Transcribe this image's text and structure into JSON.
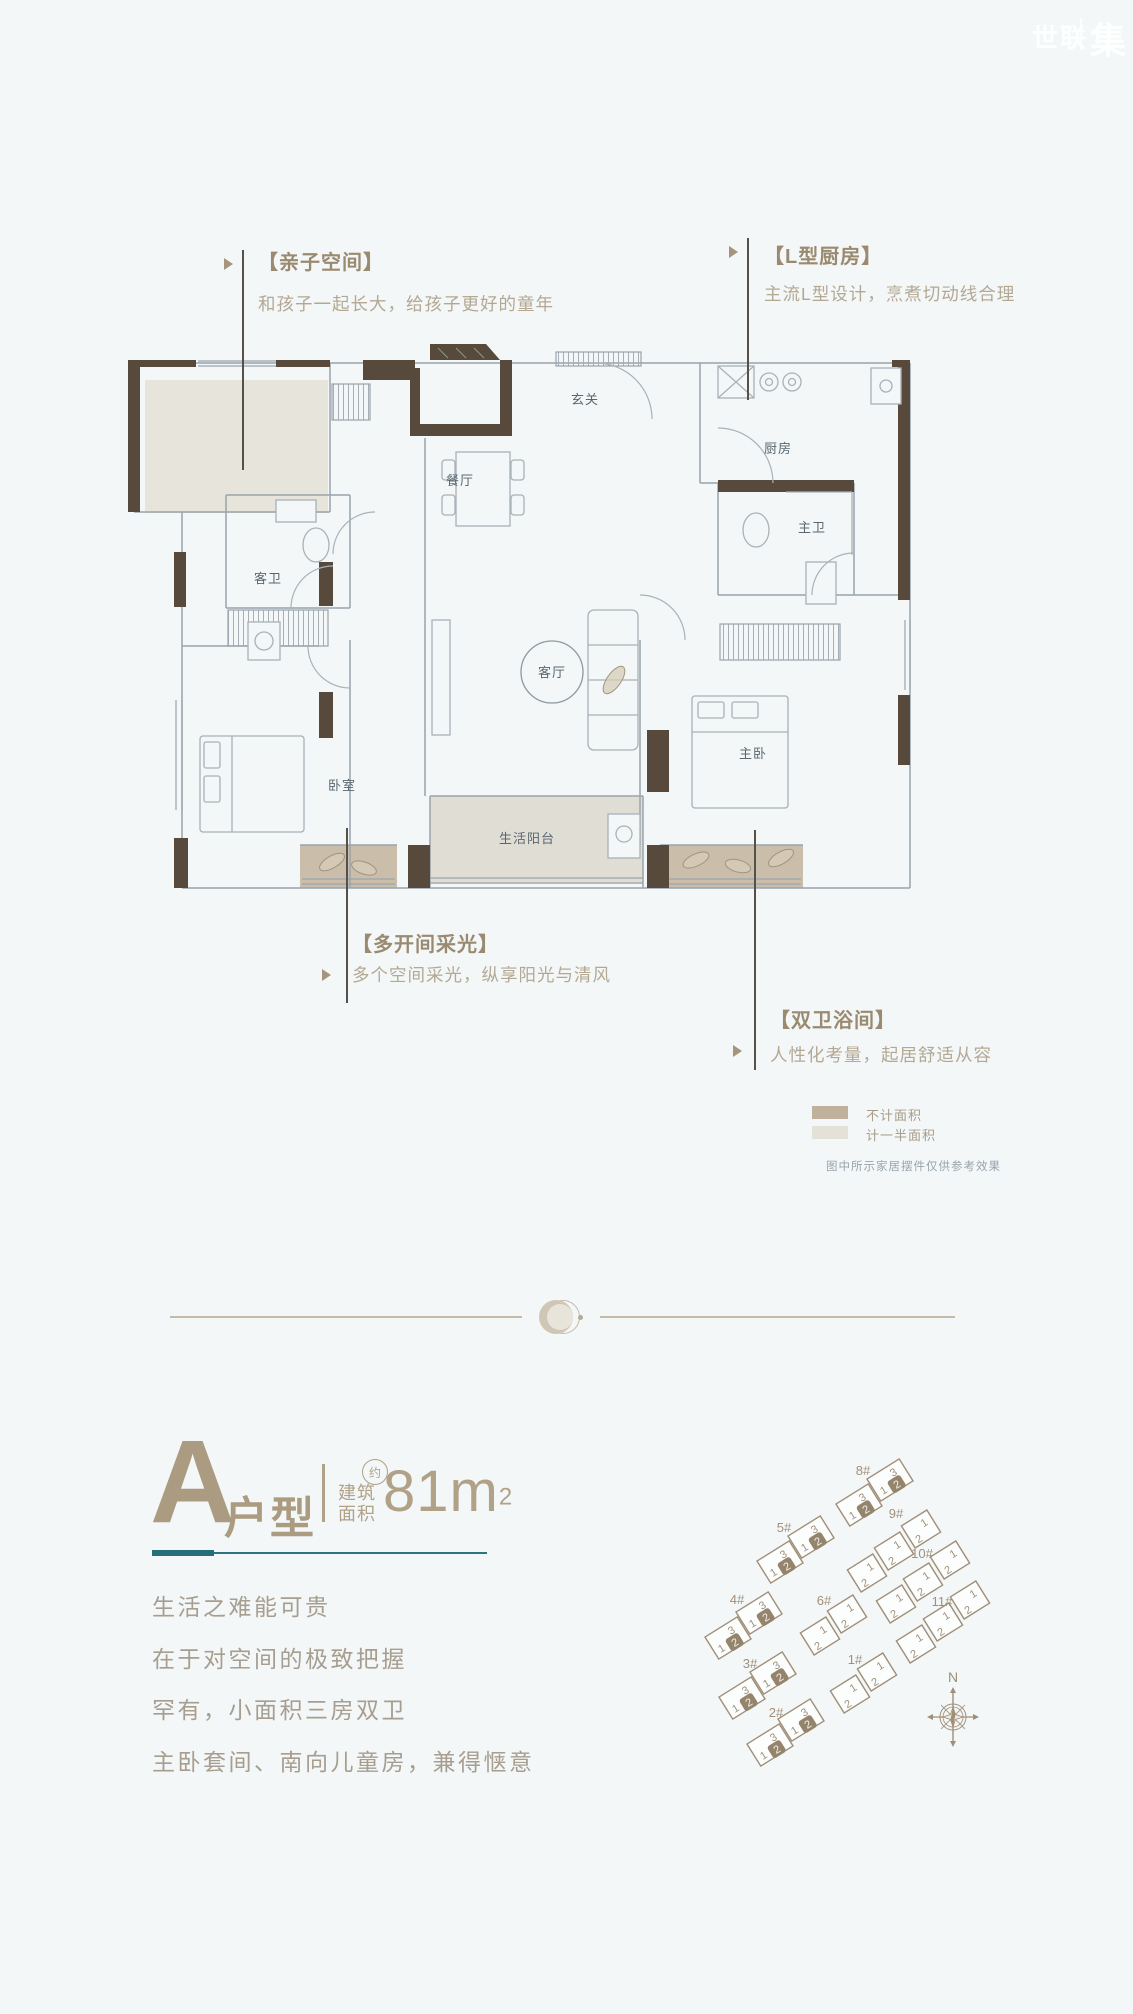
{
  "watermark": {
    "brand_left": "世联",
    "brand_right": "集"
  },
  "callouts": {
    "parent_child": {
      "title": "【亲子空间】",
      "desc": "和孩子一起长大，给孩子更好的童年"
    },
    "l_kitchen": {
      "title": "【L型厨房】",
      "desc": "主流L型设计，烹煮切动线合理"
    },
    "multi_light": {
      "title": "【多开间采光】",
      "desc": "多个空间采光，纵享阳光与清风"
    },
    "double_bath": {
      "title": "【双卫浴间】",
      "desc": "人性化考量，起居舒适从容"
    }
  },
  "floorplan": {
    "rooms": {
      "entry": "玄关",
      "dining": "餐厅",
      "kitchen": "厨房",
      "guest_bath": "客卫",
      "master_bath": "主卫",
      "living": "客厅",
      "master_bed": "主卧",
      "bedroom": "卧室",
      "balcony": "生活阳台"
    }
  },
  "legend": {
    "items": [
      {
        "label": "不计面积",
        "color": "#bfb19c"
      },
      {
        "label": "计一半面积",
        "color": "#e4e1d9"
      }
    ],
    "note": "图中所示家居摆件仅供参考效果"
  },
  "unit_info": {
    "letter": "A",
    "suffix": "户型",
    "area_prefix_line1": "建筑",
    "area_prefix_line2": "面积",
    "approx": "约",
    "area_number": "81",
    "area_unit": "m",
    "area_exponent": "2"
  },
  "slogans": [
    "生活之难能可贵",
    "在于对空间的极致把握",
    "罕有，小面积三房双卫",
    "主卧套间、南向儿童房，兼得惬意"
  ],
  "siteplan": {
    "compass_label": "N",
    "step_units": {
      "a": "1",
      "b": "3",
      "hl": "2"
    },
    "row_units": {
      "a": "1",
      "b": "2"
    },
    "buildings": [
      {
        "label": "1#",
        "type": "row",
        "blocks": 2,
        "x": 150,
        "y": 254,
        "lx": 155,
        "ly": 224
      },
      {
        "label": "2#",
        "type": "step",
        "blocks": 2,
        "x": 70,
        "y": 305,
        "lx": 76,
        "ly": 277
      },
      {
        "label": "3#",
        "type": "step",
        "blocks": 2,
        "x": 42,
        "y": 258,
        "lx": 50,
        "ly": 228
      },
      {
        "label": "4#",
        "type": "step",
        "blocks": 2,
        "x": 28,
        "y": 198,
        "lx": 37,
        "ly": 164
      },
      {
        "label": "5#",
        "type": "step",
        "blocks": 2,
        "x": 80,
        "y": 122,
        "lx": 84,
        "ly": 92
      },
      {
        "label": "6#",
        "type": "row",
        "blocks": 2,
        "x": 120,
        "y": 196,
        "lx": 124,
        "ly": 165
      },
      {
        "label": "8#",
        "type": "step",
        "blocks": 2,
        "x": 159,
        "y": 65,
        "lx": 163,
        "ly": 35
      },
      {
        "label": "9#",
        "type": "row",
        "blocks": 3,
        "x": 167,
        "y": 133,
        "lx": 196,
        "ly": 78
      },
      {
        "label": "10#",
        "type": "row",
        "blocks": 3,
        "x": 196,
        "y": 164,
        "lx": 222,
        "ly": 118
      },
      {
        "label": "11#",
        "type": "row",
        "blocks": 3,
        "x": 216,
        "y": 204,
        "lx": 242,
        "ly": 166
      }
    ]
  },
  "colors": {
    "accent_teal": "#2a6f78",
    "tan": "#ab9b80",
    "wall": "#574a3c",
    "page_bg": "#f3f7f8"
  }
}
